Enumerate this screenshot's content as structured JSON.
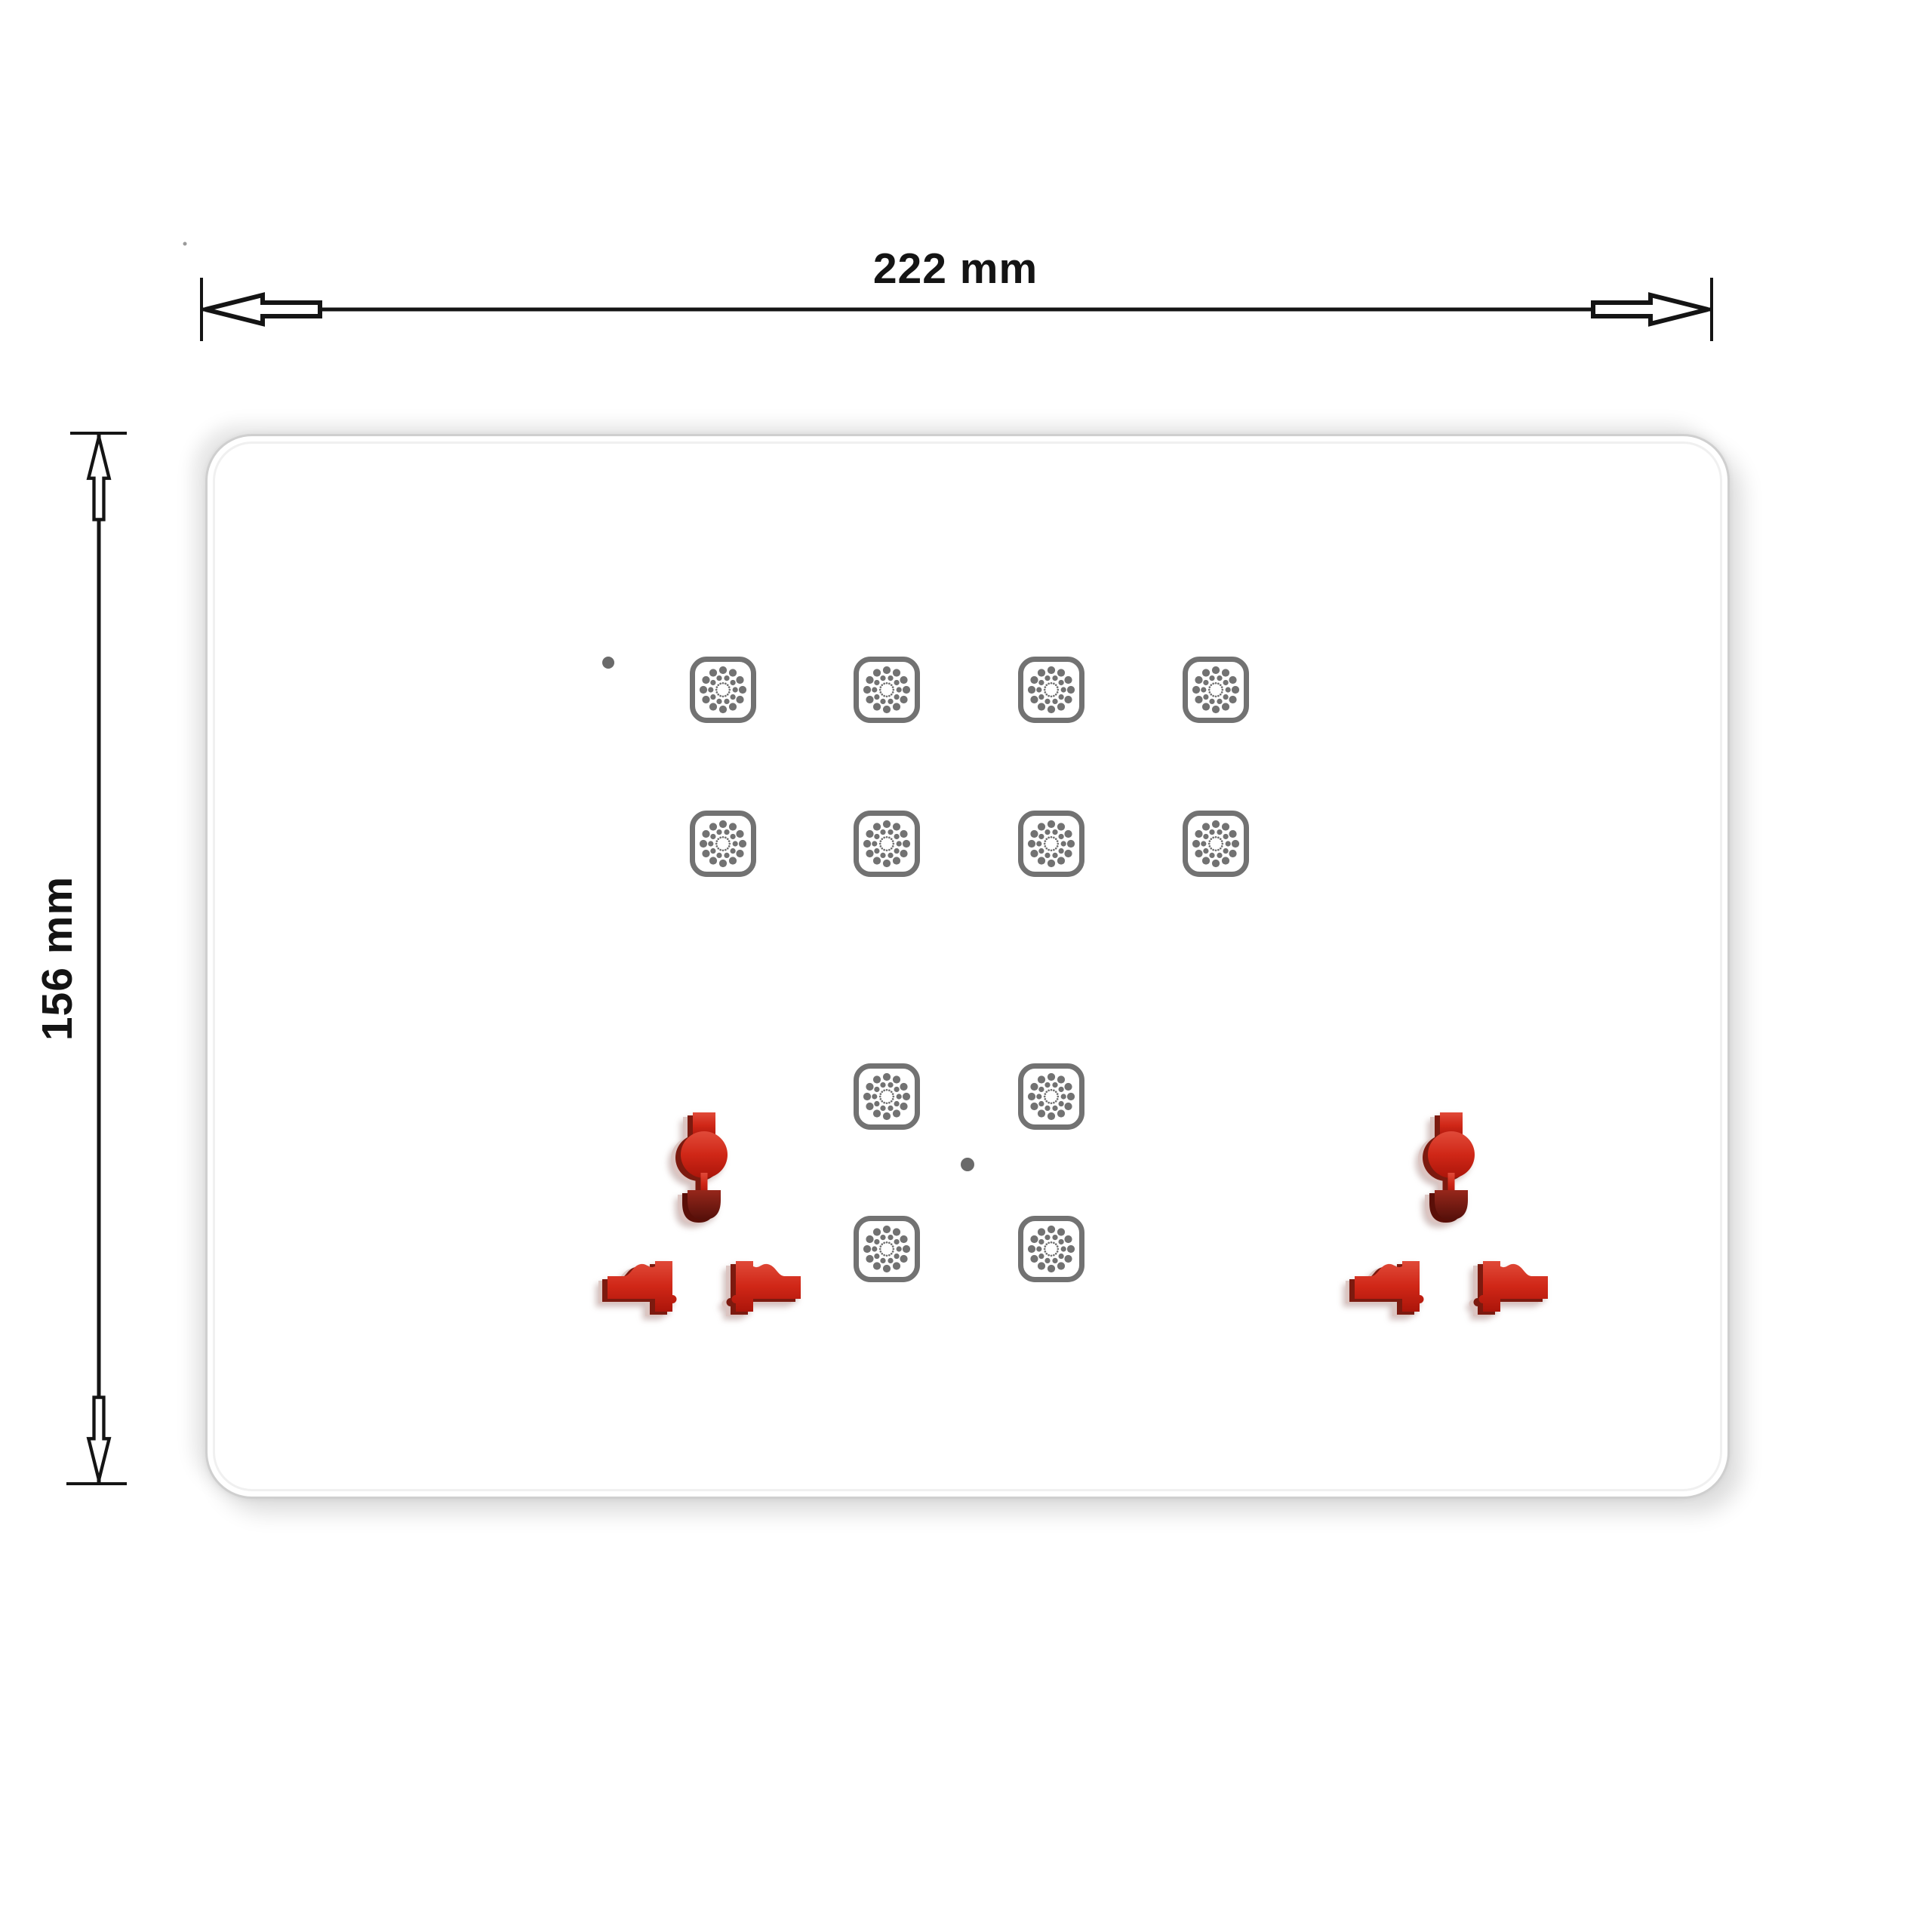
{
  "dimensions": {
    "width_label": "222 mm",
    "height_label": "156 mm"
  },
  "panel": {
    "kind": "touch switch panel front view",
    "touch_button_icon": "touch-button-dots-icon",
    "socket_icon": "universal-socket-cutout-icon",
    "top_grid": {
      "rows": 2,
      "columns": 4
    },
    "middle_grid": {
      "rows": 2,
      "columns": 2
    },
    "sockets": 2,
    "indicator_dots": 2
  },
  "colors": {
    "socket_red": "#d02717",
    "socket_deep_red": "#5a0f08",
    "icon_gray": "#727272",
    "dimension_ink": "#141414",
    "panel_white": "#ffffff"
  }
}
